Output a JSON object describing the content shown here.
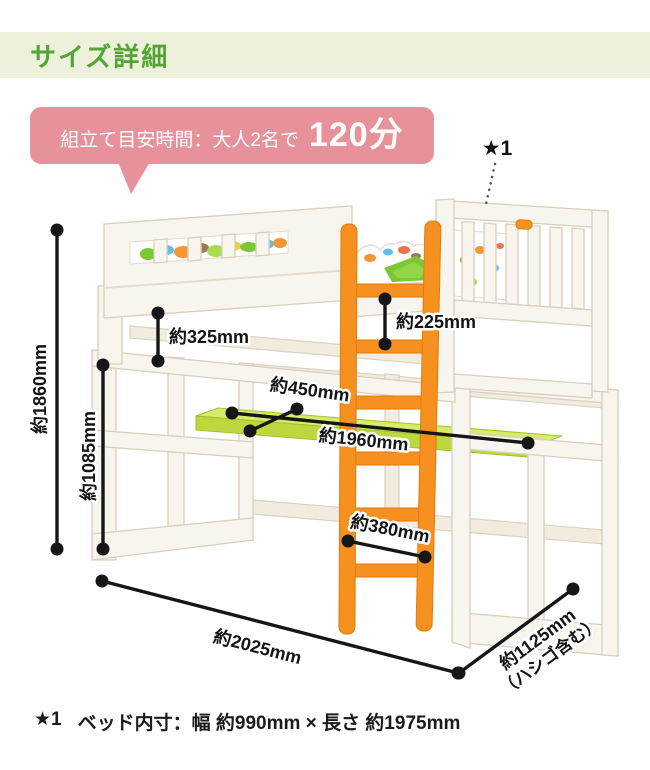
{
  "header": {
    "title": "サイズ詳細"
  },
  "bubble": {
    "label": "組立て目安時間：大人2名で",
    "value": "120分"
  },
  "star_note": {
    "marker": "★1"
  },
  "dimensions": {
    "total_height": "約1860mm",
    "under_bed_height": "約1085mm",
    "bed_frame_left": "約325mm",
    "bed_frame_right": "約225mm",
    "desk_depth": "約450mm",
    "desk_length": "約1960mm",
    "ladder_rung_width": "約380mm",
    "total_width": "約2025mm",
    "total_depth": "約1125mm",
    "total_depth_note": "（ハシゴ含む）"
  },
  "footnote": {
    "marker": "★1",
    "text": "ベッド内寸：幅 約990mm × 長さ 約1975mm"
  },
  "colors": {
    "header_bg": "#edf1dc",
    "header_text": "#53a534",
    "bubble_bg": "#e7929b",
    "ladder_orange": "#f6911f",
    "desk_green": "#c3e04a",
    "wood": "#f8f5ee",
    "dimension_line": "#161616",
    "bedding_green": "#7cc832"
  }
}
